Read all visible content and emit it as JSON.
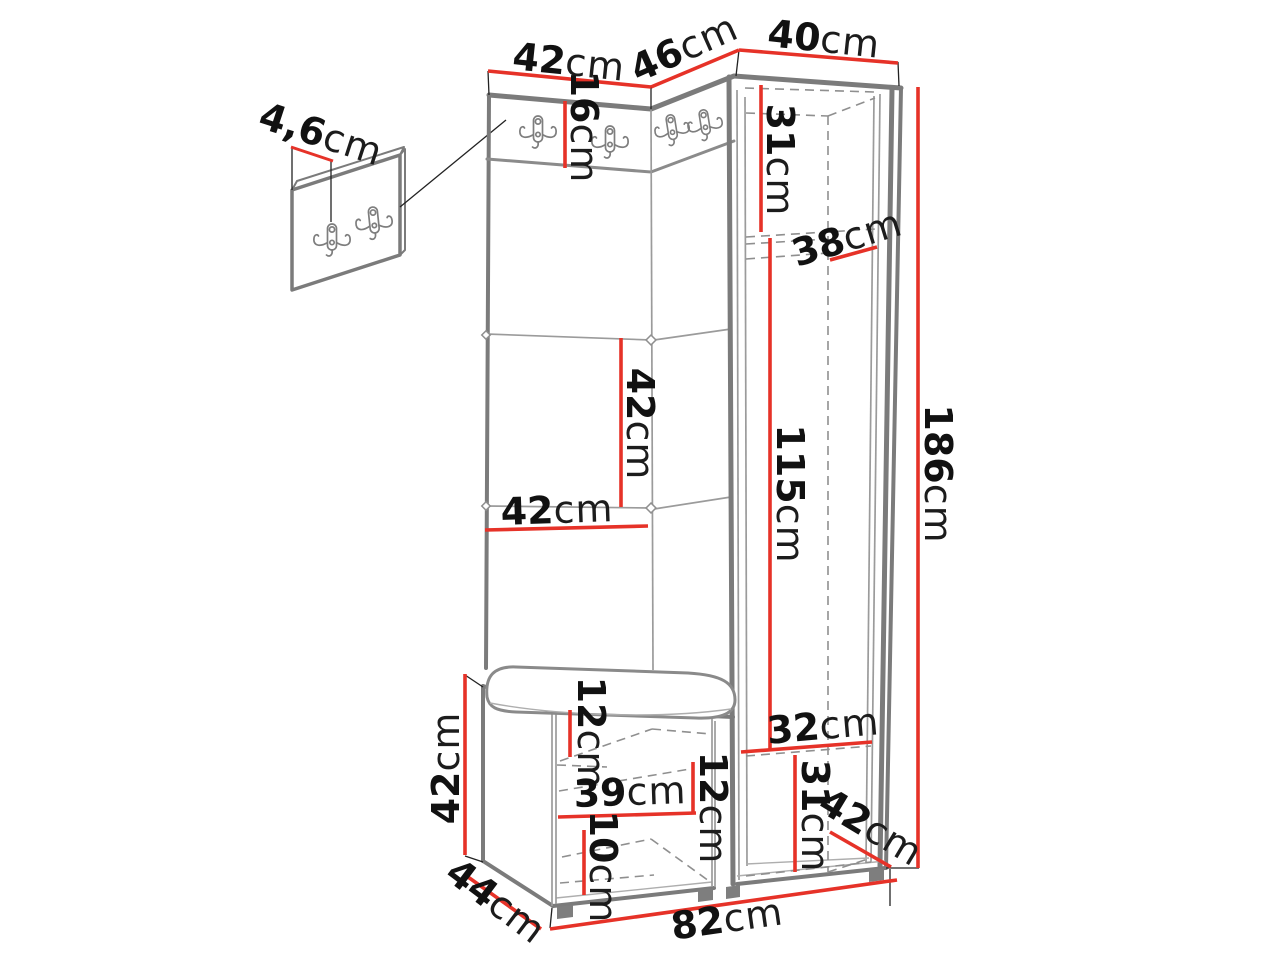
{
  "diagram": {
    "type": "furniture-dimension-drawing",
    "subject": "hallway wardrobe set with coat hooks, bench and wall hook panel",
    "unit": "cm",
    "colors": {
      "dimension_line": "#e63228",
      "outline": "#7b7b7b",
      "hidden_edge": "#8f8f8f",
      "text": "#111111",
      "background": "#ffffff"
    }
  },
  "labels": [
    {
      "id": "wall-panel-thickness",
      "value": "4,6",
      "unit": "cm"
    },
    {
      "id": "top-left-width",
      "value": "42",
      "unit": "cm"
    },
    {
      "id": "top-angled-width",
      "value": "46",
      "unit": "cm"
    },
    {
      "id": "top-right-width",
      "value": "40",
      "unit": "cm"
    },
    {
      "id": "hook-strip-height",
      "value": "16",
      "unit": "cm"
    },
    {
      "id": "upper-interior-height",
      "value": "31",
      "unit": "cm"
    },
    {
      "id": "interior-depth",
      "value": "38",
      "unit": "cm"
    },
    {
      "id": "panel-section-height",
      "value": "42",
      "unit": "cm"
    },
    {
      "id": "panel-width",
      "value": "42",
      "unit": "cm"
    },
    {
      "id": "hanging-space-height",
      "value": "115",
      "unit": "cm"
    },
    {
      "id": "total-height",
      "value": "186",
      "unit": "cm"
    },
    {
      "id": "bench-height",
      "value": "42",
      "unit": "cm"
    },
    {
      "id": "bench-top-clearance",
      "value": "12",
      "unit": "cm"
    },
    {
      "id": "bench-interior-width",
      "value": "39",
      "unit": "cm"
    },
    {
      "id": "bench-shelf-clearance",
      "value": "12",
      "unit": "cm"
    },
    {
      "id": "bench-lower-clearance",
      "value": "10",
      "unit": "cm"
    },
    {
      "id": "lower-interior-width",
      "value": "32",
      "unit": "cm"
    },
    {
      "id": "lower-interior-height",
      "value": "31",
      "unit": "cm"
    },
    {
      "id": "wardrobe-depth",
      "value": "42",
      "unit": "cm"
    },
    {
      "id": "bench-depth",
      "value": "44",
      "unit": "cm"
    },
    {
      "id": "total-width",
      "value": "82",
      "unit": "cm"
    }
  ]
}
